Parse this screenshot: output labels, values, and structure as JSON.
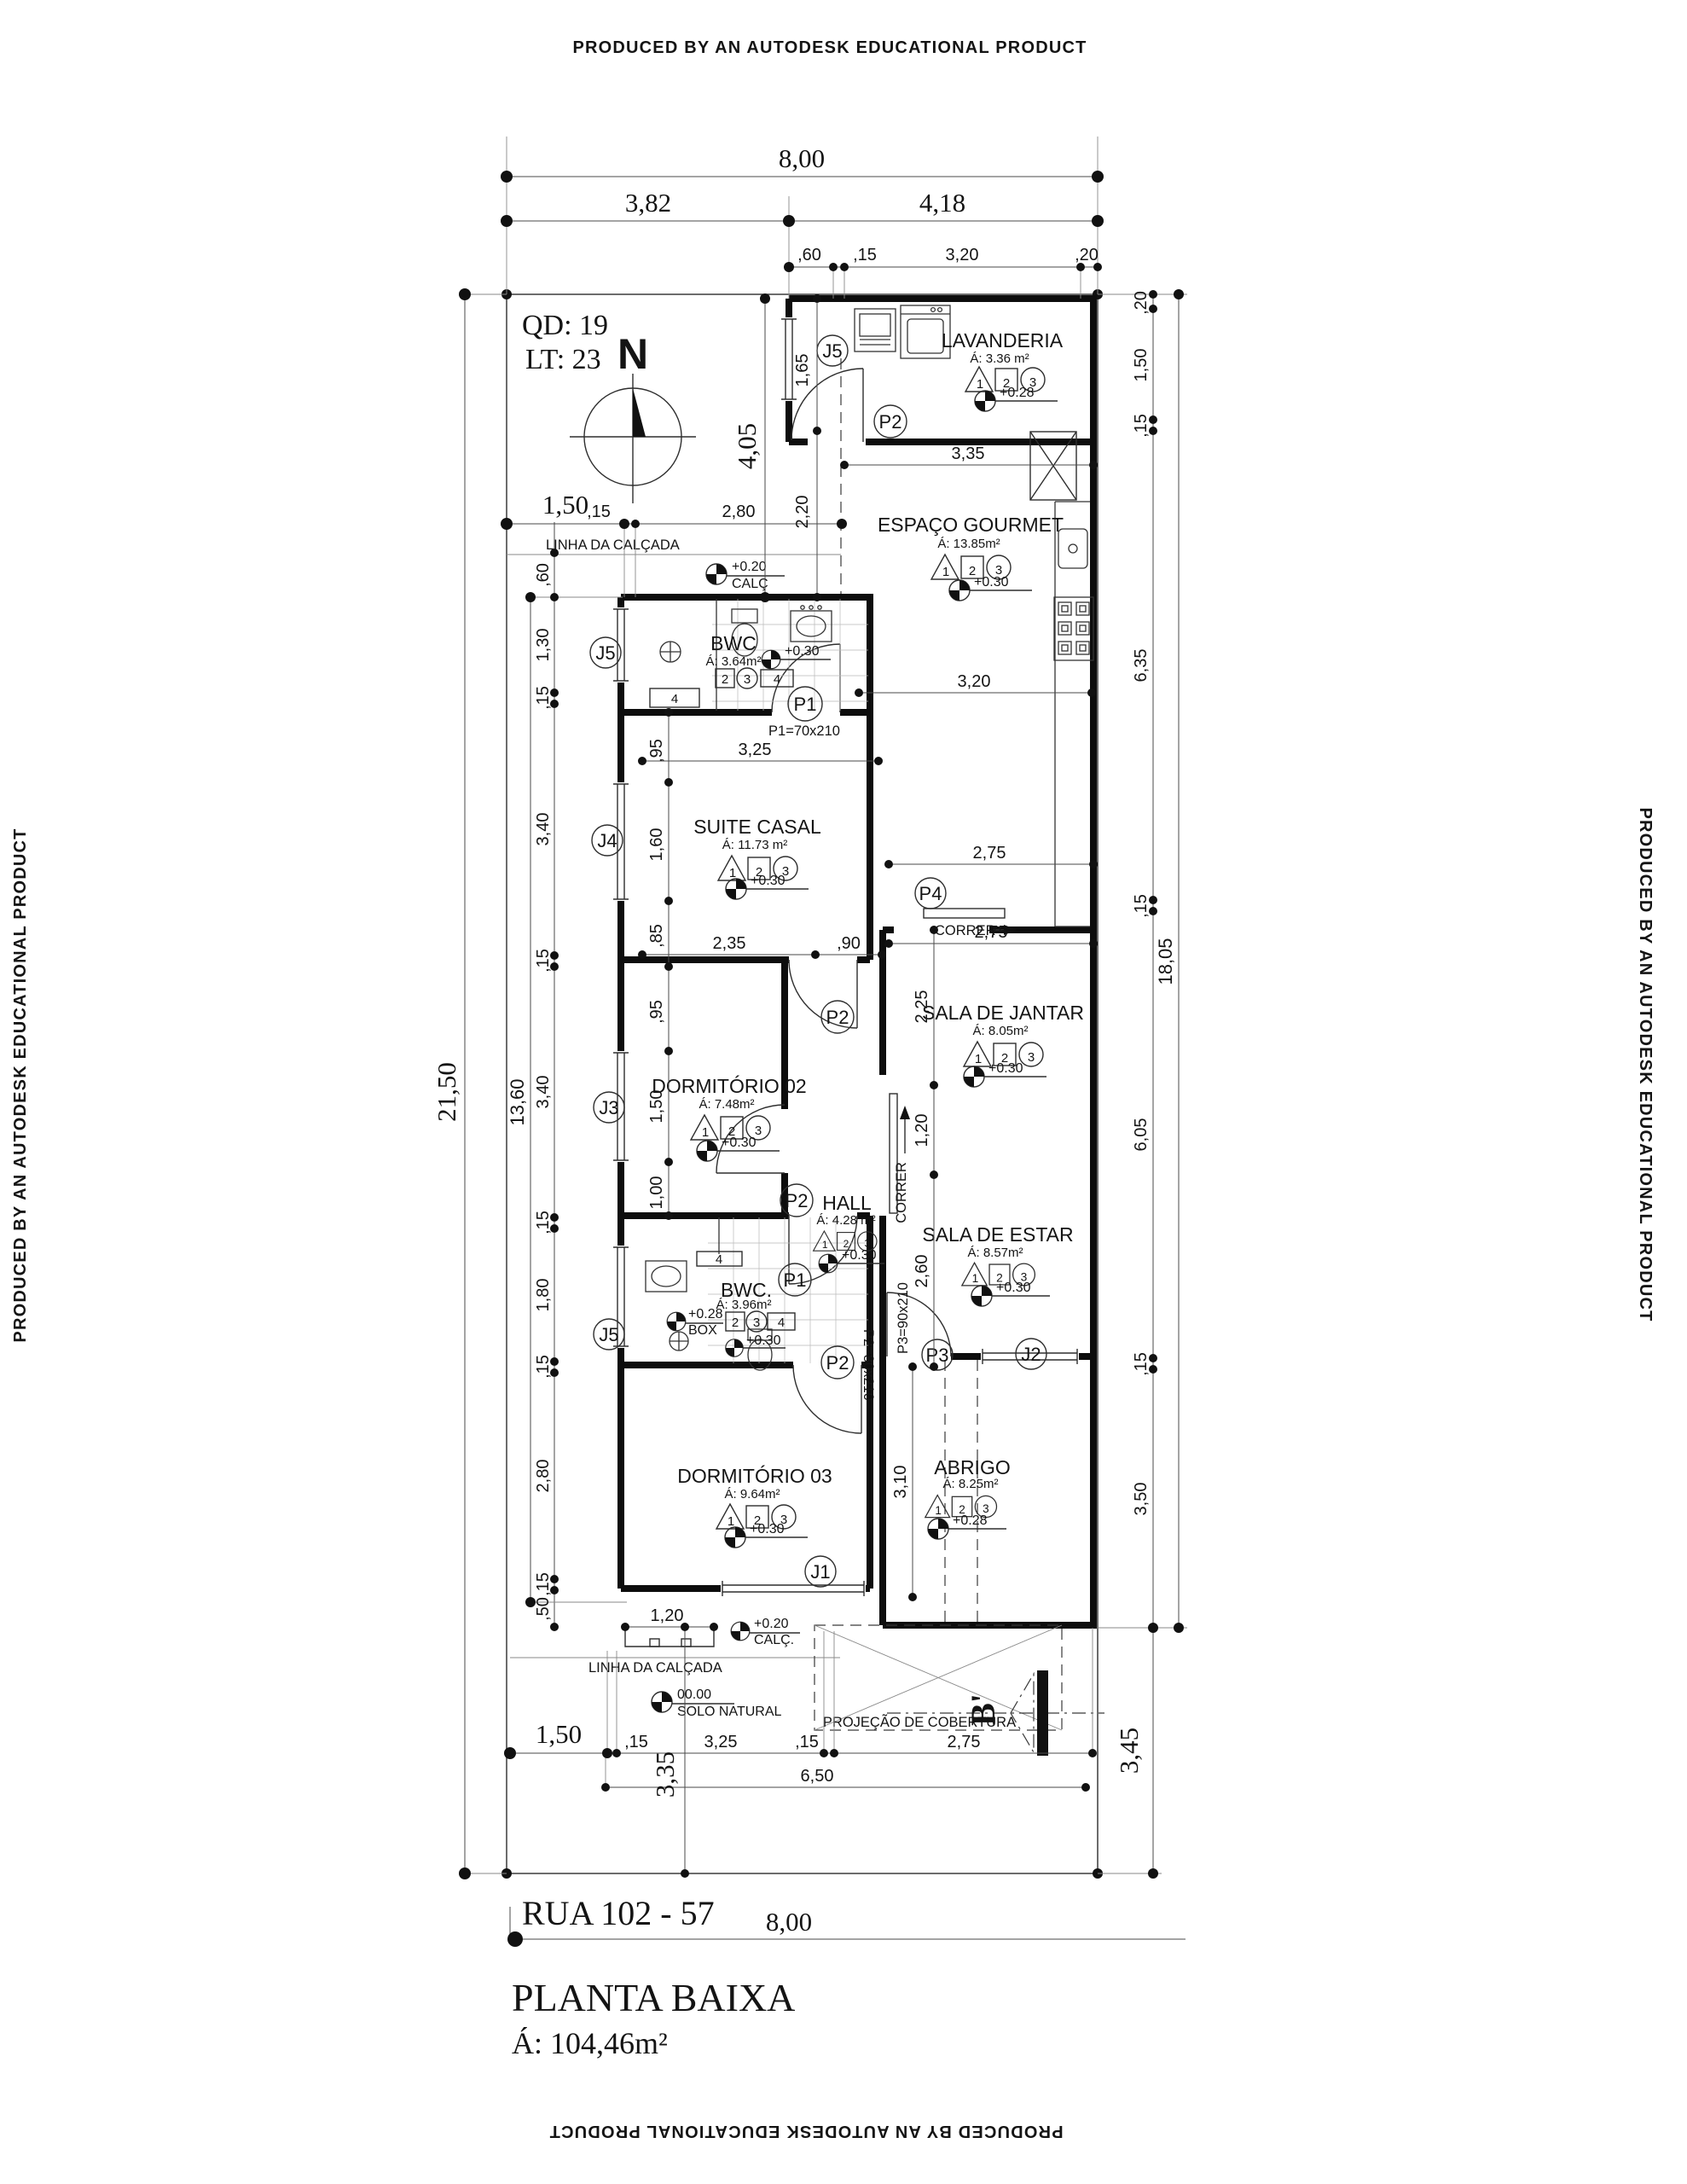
{
  "banners": {
    "text": "PRODUCED BY AN AUTODESK EDUCATIONAL PRODUCT"
  },
  "header": {
    "quadra": "QD: 19",
    "lote": "LT: 23",
    "north": "N"
  },
  "rooms": {
    "lavanderia": {
      "name": "LAVANDERIA",
      "area": "Á: 3.36 m²",
      "level": "+0.28"
    },
    "gourmet": {
      "name": "ESPAÇO GOURMET",
      "area": "Á: 13.85m²",
      "level": "+0.30"
    },
    "bwc1": {
      "name": "BWC",
      "area": "Á: 3.64m²",
      "level": "+0.30"
    },
    "suite": {
      "name": "SUITE CASAL",
      "area": "Á: 11.73 m²",
      "level": "+0.30"
    },
    "jantar": {
      "name": "SALA DE JANTAR",
      "area": "Á: 8.05m²",
      "level": "+0.30"
    },
    "dorm02": {
      "name": "DORMITÓRIO 02",
      "area": "Á: 7.48m²",
      "level": "+0.30"
    },
    "hall": {
      "name": "HALL",
      "area": "Á: 4.28 m²",
      "level": "+0.30"
    },
    "estar": {
      "name": "SALA DE ESTAR",
      "area": "Á: 8.57m²",
      "level": "+0.30"
    },
    "bwc2": {
      "name": "BWC.",
      "area": "Á: 3.96m²",
      "level": "+0.30",
      "box_level": "+0.28",
      "box": "BOX"
    },
    "dorm03": {
      "name": "DORMITÓRIO 03",
      "area": "Á: 9.64m²",
      "level": "+0.30"
    },
    "abrigo": {
      "name": "ABRIGO",
      "area": "Á: 8.25m²",
      "level": "+0.28"
    }
  },
  "symbols": {
    "s1": "1",
    "s2": "2",
    "s3": "3",
    "s4": "4"
  },
  "openings": {
    "j1": "J1",
    "j2": "J2",
    "j3": "J3",
    "j4": "J4",
    "j5": "J5",
    "p1": "P1",
    "p2": "P2",
    "p3": "P3",
    "p4": "P4",
    "p1_note": "P1=70x210",
    "p2_note": "P2=80x210",
    "p3_note": "P3=90x210"
  },
  "annotations": {
    "linha_calcada": "LINHA DA CALÇADA",
    "calc_level": "+0.20",
    "calc": "CALÇ",
    "calc_dot": "CALÇ.",
    "solo_level": "00.00",
    "solo": "SOLO NATURAL",
    "projecao": "PROJEÇÃO DE COBERTURA",
    "correr": "CORRER",
    "section_b": "B'"
  },
  "dims": {
    "top": [
      "8,00",
      "3,82",
      "4,18",
      ",60",
      ",15",
      "3,20",
      ",20"
    ],
    "left": [
      "21,50",
      "13,60"
    ],
    "left_chain": [
      ",60",
      "1,30",
      ",15",
      "3,40",
      ",15",
      "3,40",
      ",15",
      "1,80",
      ",15",
      "2,80",
      ",15",
      ",50"
    ],
    "left_top": [
      "1,50",
      ",15",
      "2,80",
      "4,05",
      "1,65",
      "2,20"
    ],
    "suite_chain": [
      ",95",
      "1,60",
      ",85"
    ],
    "dorm02_chain": [
      ",95",
      "1,50",
      "1,00"
    ],
    "right_chain": [
      ",20",
      "1,50",
      ",15",
      "6,35",
      ",15",
      "6,05",
      ",15",
      "3,50"
    ],
    "right": [
      "18,05",
      "3,45"
    ],
    "center_chain": [
      "2,25",
      "1,20",
      "2,60",
      "3,10"
    ],
    "h": [
      "3,35",
      "3,20",
      "3,25",
      "2,35",
      ",90",
      "2,75",
      "2,75",
      "1,20"
    ],
    "bottom_chain": [
      "1,50",
      ",15",
      "3,25",
      ",15",
      "2,75"
    ],
    "bottom": [
      "6,50",
      "3,35"
    ]
  },
  "street": {
    "name": "RUA  102 - 57",
    "width": "8,00"
  },
  "title": {
    "name": "PLANTA BAIXA",
    "area": "Á: 104,46m²"
  }
}
